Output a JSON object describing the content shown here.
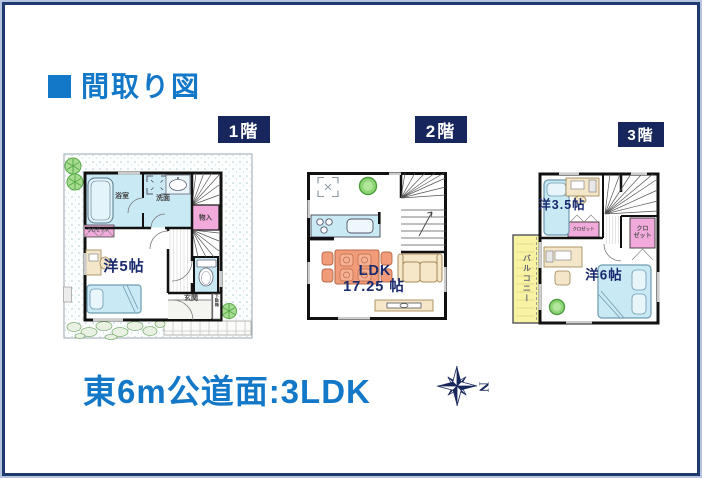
{
  "header": {
    "title": "間取り図"
  },
  "floors": [
    {
      "label": "1階",
      "rooms": {
        "bath": "浴室",
        "washroom": "洗面",
        "storage": "物入",
        "closet": "クロゼット",
        "western": "洋5帖",
        "entrance": "玄関",
        "shoebox": "下駄箱"
      }
    },
    {
      "label": "2階",
      "rooms": {
        "ldk_name": "LDK",
        "ldk_size": "17.25 帖"
      }
    },
    {
      "label": "3階",
      "rooms": {
        "western_small": "洋3.5帖",
        "closet_center": "クロゼット",
        "closet_right_top": "クロ",
        "closet_right_bottom": "ゼット",
        "balcony": "バルコニー",
        "western_main": "洋6帖"
      }
    }
  ],
  "footer": {
    "caption": "東6m公道面:3LDK",
    "compass_letter": "N"
  },
  "colors": {
    "accent_blue": "#1478c8",
    "label_navy": "#17265c",
    "size_text_navy": "#1a2a6e",
    "water_blue": "#c9e9f5",
    "closet_pink": "#f2aadc",
    "furniture_orange": "#f19b78",
    "furniture_cream": "#f5e7c8",
    "balcony_yellow": "#f8f3a2",
    "plant_green": "#8ed675"
  }
}
